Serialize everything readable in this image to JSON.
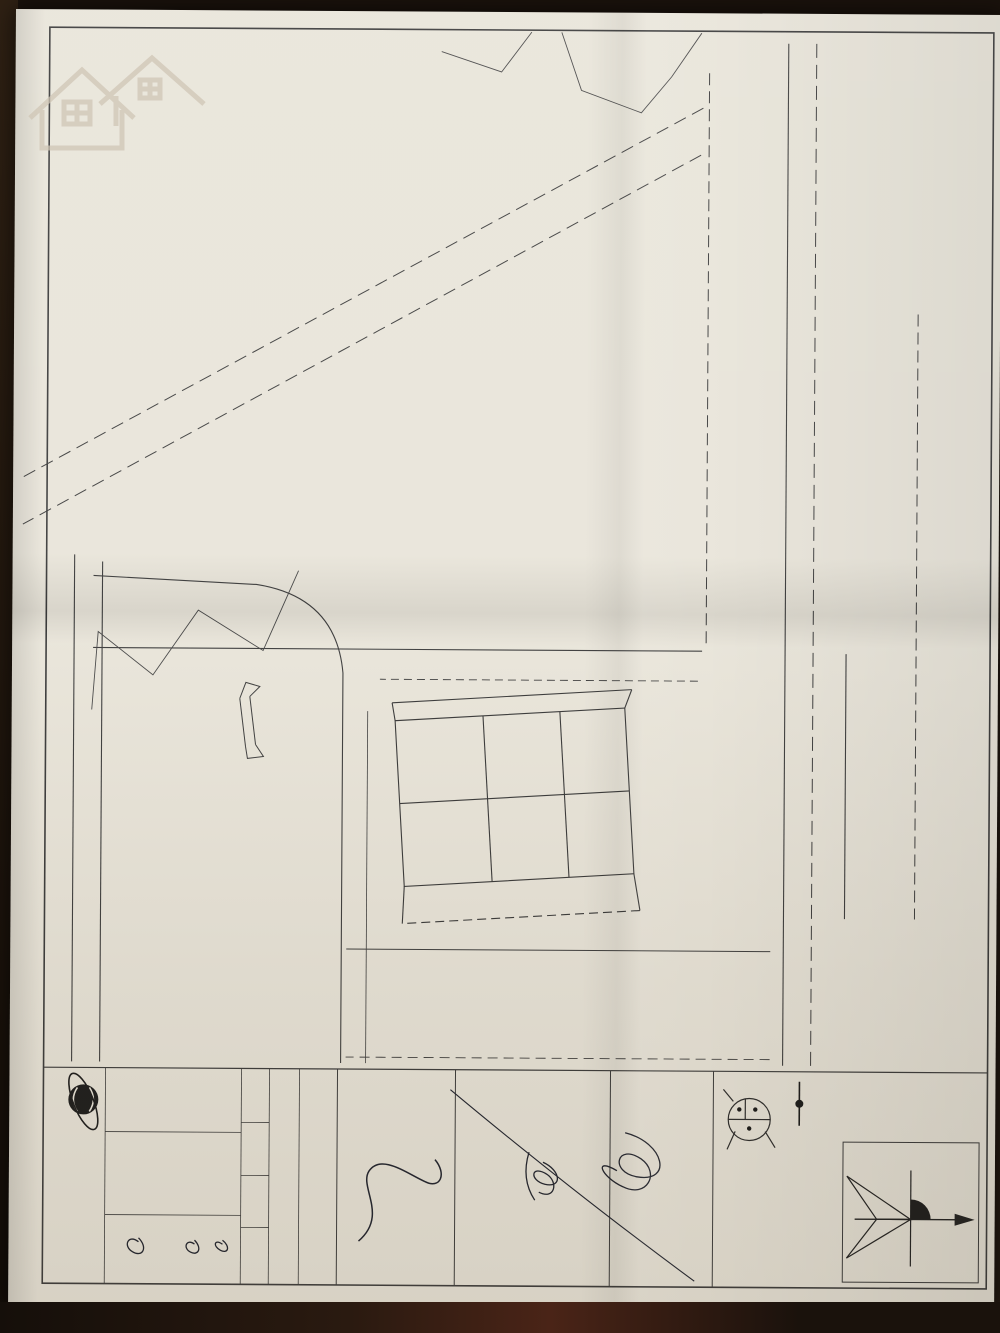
{
  "colors": {
    "paper": "#e9e5da",
    "ink": "#262626",
    "stamp_red": "#bf3a2b",
    "stamp_dark": "#2d2a28",
    "dots": "#161616"
  },
  "watermark": {
    "name": "SoSanhnha.com",
    "tagline": "Great choice for you"
  },
  "header": {
    "title": "BẢN ĐỒ QUY HOẠCH CHIA LÔ",
    "sub1": "ĐIỀU CHỈNH QUY HOẠCH CHI TIẾT TỶ LỆ 1:500 DỰ ÁN XÂY DỰNG CƠ SỞ HẠ TẦNG PHỤC VỤ",
    "sub2": "ĐẤU GIÁ QUYỀN SỬ DỤNG ĐẤT TẠI TỔ DÂN PHỐ PHẤN DŨNG, PHƯỜNG ANH DŨNG",
    "sub3": "ĐỊA ĐIỂM :  PHƯỜNG ANH DŨNG - QUẬN DƯƠNG KINH - TP. HẢI PHÒNG"
  },
  "table": {
    "title": "BẢNG THỐNG KÊ CÁC LÔ ĐẤT",
    "headers": [
      "TT",
      "TÊN LÔ",
      "KÝ HIỆU LÔ ĐẤT",
      "TỔNG SỐ LÔ",
      "SỐ LÔ",
      "DIỆN TÍCH (m2)",
      "TẦNG CAO",
      "MẬT ĐỘ XÂY DỰNG TỐI ĐA (%)",
      "TỔNG DIỆN TÍCH (m2)"
    ],
    "group": {
      "tt": "1",
      "name": "ĐẤT PHÂN LÔ ĐẤU GIÁ QUYỀN SỬ DỤNG ĐẤT Ở",
      "ky_hieu": "N",
      "tong_so_lo": "6",
      "tong_dien_tich": "776,00",
      "rows": [
        {
          "so_lo": "1",
          "dien_tich": "138,10",
          "tang_cao": "5",
          "mat_do": "82",
          "tdt": "138,10"
        },
        {
          "so_lo": "2",
          "dien_tich": "132,00",
          "tang_cao": "5",
          "mat_do": "84",
          "tdt": "264,00"
        },
        {
          "so_lo": "1",
          "dien_tich": "134,34",
          "tang_cao": "5",
          "mat_do": "83",
          "tdt": "134,34"
        },
        {
          "so_lo": "1",
          "dien_tich": "120,78",
          "tang_cao": "5",
          "mat_do": "86",
          "tdt": "120,78"
        },
        {
          "so_lo": "1",
          "dien_tich": "118,78",
          "tang_cao": "5",
          "mat_do": "86",
          "tdt": "118,78"
        }
      ]
    },
    "gt_row": {
      "tt": "2",
      "name": "ĐẤT GIAO THÔNG (HÈ, ĐƯỜNG SỬ DỤNG CHUNG)",
      "ky_hieu": "GT",
      "tdt": "619,15"
    },
    "total_row": {
      "label": "TỔNG DIỆN TÍCH",
      "value": "1395,15"
    }
  },
  "map": {
    "road_quy_hoach": "ĐƯỜNG QUY HOẠCH",
    "road_quy_hoach_2": "ĐƯỜNG QUY HOẠCH",
    "pho_hop_hoa": "Phố Hợp Hòa",
    "duong_be_tong": "đường bê tông",
    "duong_be_tong_2": "đường bê tông",
    "muong": "mương",
    "khu_dan_cu": "Khu dân cư",
    "ruong_lua": "ruộng lúa",
    "ao_1": "ao",
    "ao_2": "ao",
    "khu_dat_line1": "Khu đất đã có",
    "khu_dat_line2": "quy hoạch chi tiết tỷ lệ 1/500",
    "lots": [
      {
        "id": "N-1",
        "area": "138,10",
        "x": 742,
        "y": 400
      },
      {
        "id": "N-6",
        "area": "118,78",
        "x": 827,
        "y": 400
      },
      {
        "id": "N-2",
        "area": "132,00",
        "x": 744,
        "y": 471
      },
      {
        "id": "N-5",
        "area": "120,78",
        "x": 827,
        "y": 468
      },
      {
        "id": "N-3",
        "area": "134,34",
        "x": 747,
        "y": 554
      },
      {
        "id": "N-4",
        "area": "132,00",
        "x": 829,
        "y": 551
      }
    ],
    "center_lot": {
      "id": "N",
      "area": "776,00",
      "floors": "5",
      "x": 785,
      "y": 442
    },
    "gt_lot": {
      "id": "GT",
      "area": "619,15",
      "x": 888,
      "y": 506
    },
    "dims": [
      {
        "t": "10,71",
        "x": 424,
        "y": 284,
        "r": 0
      },
      {
        "t": "11,54",
        "x": 508,
        "y": 282,
        "r": 0
      },
      {
        "t": "9,54",
        "x": 594,
        "y": 280,
        "r": 0
      },
      {
        "t": "9,54",
        "x": 666,
        "y": 276,
        "r": 0
      },
      {
        "t": "3,0M",
        "x": 640,
        "y": 158,
        "r": -50
      },
      {
        "t": "2,79",
        "x": 676,
        "y": 196,
        "r": 90
      },
      {
        "t": "12,53",
        "x": 856,
        "y": 112,
        "r": 90
      },
      {
        "t": "10,53",
        "x": 762,
        "y": 186,
        "r": 90
      },
      {
        "t": "10,50",
        "x": 888,
        "y": 186,
        "r": 90
      },
      {
        "t": "2,00",
        "x": 822,
        "y": 122,
        "r": 90
      },
      {
        "t": "7,00",
        "x": 848,
        "y": 136,
        "r": 90
      },
      {
        "t": "11,83",
        "x": 698,
        "y": 392,
        "r": 90
      },
      {
        "t": "11,13",
        "x": 702,
        "y": 472,
        "r": 90
      },
      {
        "t": "8,35",
        "x": 706,
        "y": 528,
        "r": 90
      },
      {
        "t": "10,34",
        "x": 709,
        "y": 563,
        "r": 90
      },
      {
        "t": "2,96",
        "x": 680,
        "y": 352,
        "r": 45
      },
      {
        "t": "11,50",
        "x": 763,
        "y": 432,
        "r": 90
      },
      {
        "t": "10,50",
        "x": 772,
        "y": 502,
        "r": 90
      },
      {
        "t": "12,73",
        "x": 737,
        "y": 520,
        "r": 90
      },
      {
        "t": "11,50",
        "x": 792,
        "y": 548,
        "r": 90
      },
      {
        "t": "10,50",
        "x": 808,
        "y": 468,
        "r": 90
      },
      {
        "t": "11,58",
        "x": 876,
        "y": 404,
        "r": 90
      },
      {
        "t": "8,50",
        "x": 878,
        "y": 332,
        "r": 90
      },
      {
        "t": "9,50",
        "x": 896,
        "y": 352,
        "r": 90
      },
      {
        "t": "2,89",
        "x": 900,
        "y": 432,
        "r": 90
      },
      {
        "t": "10,79",
        "x": 748,
        "y": 610,
        "r": 0
      },
      {
        "t": "11,50",
        "x": 800,
        "y": 612,
        "r": 0
      },
      {
        "t": "9,50",
        "x": 852,
        "y": 614,
        "r": 0
      },
      {
        "t": "8,51",
        "x": 704,
        "y": 598,
        "r": 90
      },
      {
        "t": "4,77",
        "x": 692,
        "y": 588,
        "r": 90
      },
      {
        "t": "2,00",
        "x": 916,
        "y": 546,
        "r": 0
      },
      {
        "t": "7,00",
        "x": 936,
        "y": 522,
        "r": 90
      }
    ]
  },
  "legend": {
    "heading": "KÝ HIỆU:",
    "boundary": "RANH GIỚI NGHIÊN CỨU QUY HOẠCH, DIỆN TÍCH: 1395,15 M2",
    "sym_top": "KÝ HIỆU LÔ ĐẤT",
    "sym_right": "DIỆN TÍCH",
    "sym_left": "SỐ TẦNG",
    "north": "B"
  },
  "approvals": {
    "pheduyet": {
      "heading": "CƠ QUAN PHÊ DUYỆT:",
      "org": "ỦY BAN NHÂN DÂN QUẬN DƯƠNG KINH",
      "role": "CHỦ TỊCH",
      "signer": "Nguyễn Minh Phương",
      "stamp_ring": "ỦY BAN NHÂN DÂN • QUẬN DƯƠNG KINH •",
      "stamp_center": "★"
    },
    "thamdinh": {
      "heading": "CƠ QUAN THẨM ĐỊNH:",
      "org": "PHÒNG QUẢN LÝ ĐÔ THỊ QUẬN DƯƠNG KINH",
      "note": "Kèm theo Quyết định số 4A /QĐ-UBND ngày 14 tháng 02 năm 2022",
      "stamp_ring": "QUẬN DƯƠNG KINH • THÀNH PHỐ HẢI PHÒNG •",
      "stamp_center": "PHÒNG|QUẢN LÝ|ĐÔ THỊ"
    },
    "chudautu": {
      "heading": "ĐẠI DIỆN CHỦ ĐẦU TƯ:",
      "org": "TRUNG TÂM PHÁT TRIỂN QUỸ ĐẤT QUẬN DƯƠNG KINH",
      "role": "GIÁM ĐỐC",
      "signer": "Bùi Đức Hợi",
      "note": "Kèm theo văn bản số 05/TTr",
      "stamp_ring": "ỦY BAN NHÂN DÂN QUẬN DƯƠNG KINH •",
      "stamp_center": "TRUNG TÂM|PHÁT TRIỂN|QUỸ ĐẤT"
    }
  },
  "frame_block": {
    "cong_trinh_label": "CÔNG TRÌNH - ĐỊA ĐIỂM:",
    "line1": "ĐIỀU CHỈNH QUY HOẠCH CHI TIẾT TỶ LỆ 1:500 DỰ ÁN XÂY DỰNG CƠ SỞ HẠ TẦNG PHỤC VỤ",
    "line2": "ĐẤU GIÁ QUYỀN SỬ DỤNG ĐẤT TẠI TỔ DÂN PHỐ PHẤN DŨNG, PHƯỜNG ANH DŨNG",
    "line3": "ĐỊA ĐIỂM : PHƯỜNG ANH DŨNG - QUẬN DƯƠNG KINH - THÀNH PHỐ HẢI PHÒNG",
    "ten_ban_ve_label": "Tên bản vẽ:",
    "drawing_title": "BẢN ĐỒ QUY HOẠCH CHIA LÔ",
    "cells": [
      "BẢN VẼ QH-05",
      "1 A3",
      "TỶ LỆ 1:500",
      "THÁNG 02/2022"
    ],
    "roles": [
      {
        "label": "THIẾT KẾ",
        "name": "KTS. NGUYỄN VĂN SINH"
      },
      {
        "label": "CHỦ TRÌ",
        "name": "KTS. NGUYỄN VĂN SINH"
      },
      {
        "label": "CHỦ NHIỆM",
        "name": ""
      },
      {
        "label": "TRƯỞNG PHÒNG",
        "name": ""
      },
      {
        "label": "QUẢN LÝ KỸ THUẬT",
        "name": ""
      },
      {
        "label": "GIÁM ĐỐC",
        "name": ""
      }
    ],
    "logo": "DC",
    "company_stamp_ring": "CÔNG TY CỔ PHẦN TƯ VẤN KHẢO SÁT THIẾT KẾ • VÀ DỊCH VỤ THƯƠNG MẠI •",
    "company_stamp_center": "MIỀN BẮC|HẢI PHÒNG",
    "company_line": "CÔNG TY CP TƯ VẤN KHẢO SÁT THIẾT KẾ VÀ DỊCH VỤ THƯƠNG MẠI MIỀN BẮC - PHƯỜNG BẮC SƠN - QUẬN KIẾN AN - TP. HẢI PHÒNG"
  }
}
